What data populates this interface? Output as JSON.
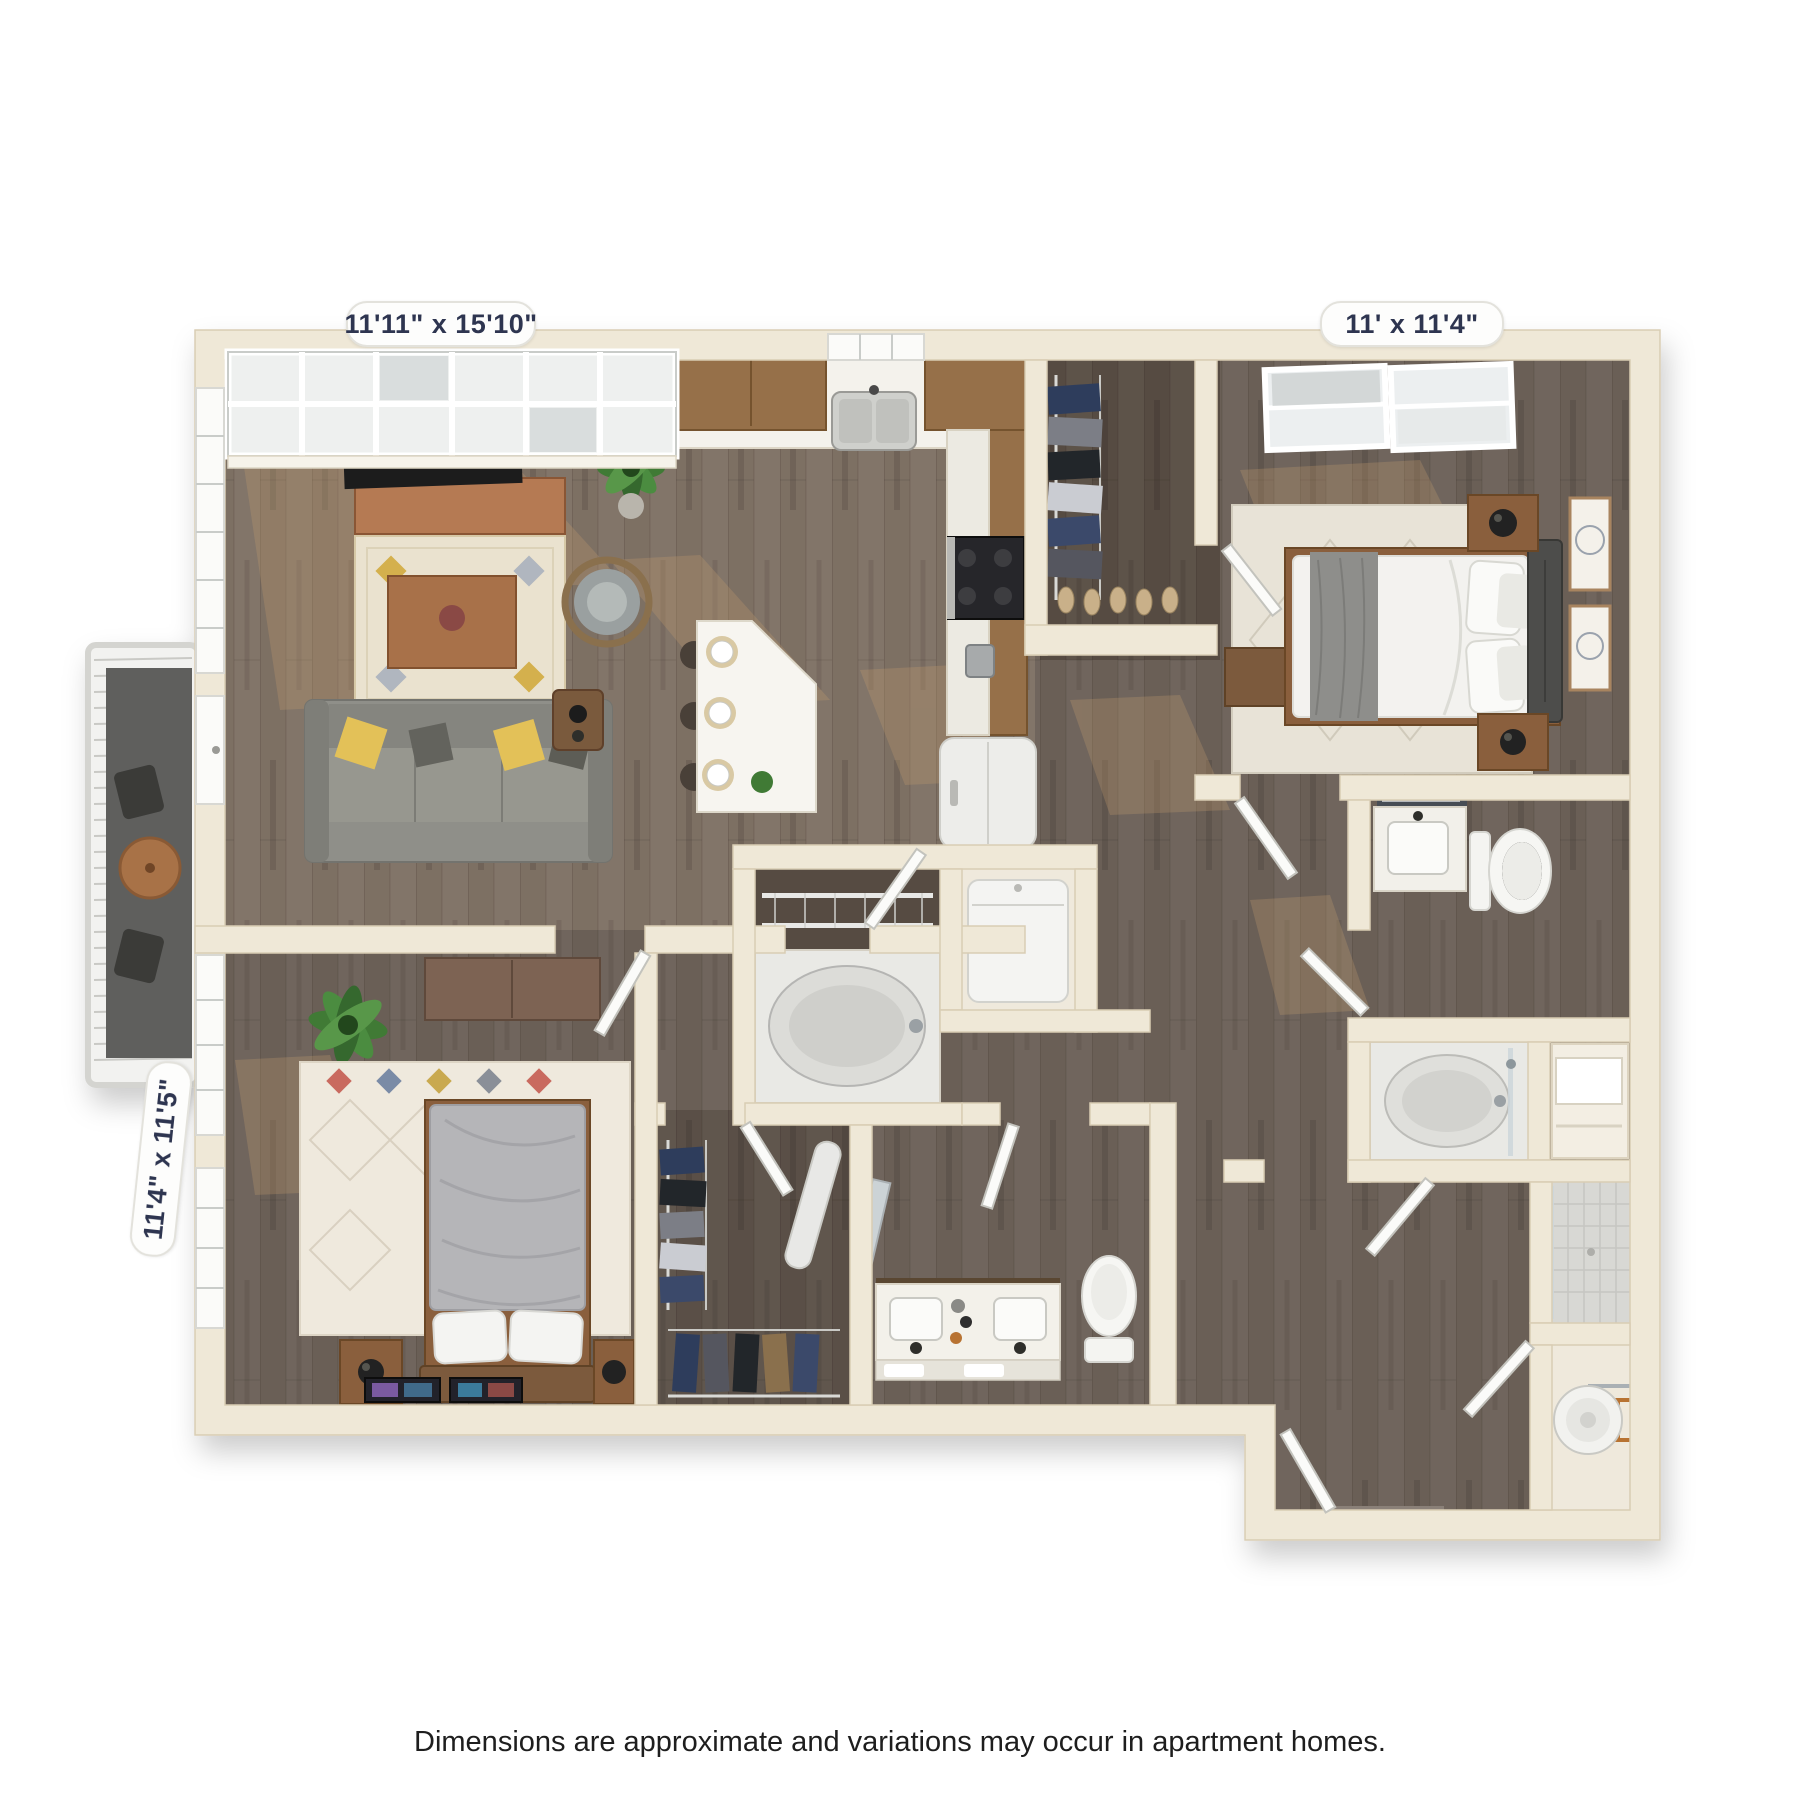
{
  "background": "#ffffff",
  "labels": {
    "living": {
      "text": "11'11\" x 15'10\"",
      "room": "living-room",
      "position": "top-left"
    },
    "bedroom_right": {
      "text": "11' x 11'4\"",
      "room": "bedroom-right",
      "position": "top-right"
    },
    "bedroom_left": {
      "text": "11'4\" x 11'5\"",
      "room": "bedroom-left",
      "position": "left-rotated"
    }
  },
  "disclaimer": {
    "text": "Dimensions are approximate and variations may occur in apartment homes."
  },
  "palette": {
    "background": "#ffffff",
    "wall": "#efe8d7",
    "wall_edge": "#d9cdb4",
    "floor_wood_main": "#6a5f56",
    "floor_wood_light": "#7d6f63",
    "floor_closet_dark": "#564b42",
    "label_text": "#2e3550",
    "label_bg": "#fdfdfc",
    "counter_white": "#f4f2ec",
    "cabinet_wood": "#966f49",
    "console_copper": "#b57a52",
    "sofa_gray": "#8f8f89",
    "pillow_yellow": "#e3c158",
    "rug_cream": "#eae2cf",
    "rug_diamond_yellow": "#d4b04e",
    "bed_white": "#f3f2ef",
    "bed_gray_throw": "#8e8e8b",
    "duvet_gray": "#b5b5b8",
    "headboard_dark": "#4e4d4b",
    "fixture_white": "#f4f4f1",
    "tub_gray": "#d6d6d2",
    "tile_gray": "#d8d8d4",
    "clothes_navy": "#2f3d5c",
    "plant_green": "#3f7a35",
    "copper_pipe": "#b87333",
    "disclaimer_text": "#1e1e1e",
    "sun_patch": "#c79d6f"
  },
  "depicted_rooms": [
    "living-room",
    "kitchen",
    "bedroom-right",
    "bedroom-left",
    "walk-in-closet-right",
    "walk-in-closet-left",
    "bathroom-right",
    "bathroom-center",
    "linen-niche",
    "laundry-closet",
    "entry-hall",
    "shower-stall",
    "water-heater-closet",
    "balcony"
  ],
  "depicted_fixtures": [
    "sofa",
    "tv",
    "tv-console",
    "coffee-table",
    "accent-chair",
    "side-table",
    "kitchen-island",
    "kitchen-sink",
    "stove",
    "fridge",
    "bed",
    "nightstand",
    "table-lamp",
    "dresser",
    "garden-tub",
    "double-vanity",
    "toilet",
    "washer",
    "water-heater",
    "potted-plant",
    "area-rug",
    "wall-art",
    "door",
    "window",
    "skylight",
    "wire-shelving",
    "hanging-clothes",
    "ironing-board",
    "balcony-table"
  ]
}
